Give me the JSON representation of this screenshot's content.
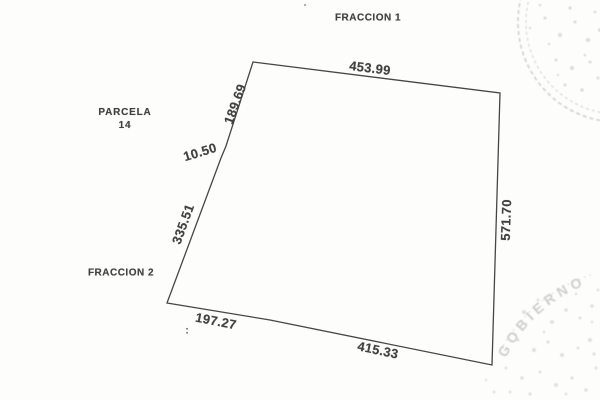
{
  "labels": {
    "fraccion1": "FRACCION 1",
    "parcela_line1": "PARCELA",
    "parcela_line2": "14",
    "fraccion2": "FRACCION 2",
    "stray_mark": ":"
  },
  "measurements": {
    "top": "453.99",
    "upper_left": "189.69",
    "notch": "10.50",
    "left": "335.51",
    "bottom_left": "197.27",
    "bottom": "415.33",
    "right": "571.70"
  },
  "stamps": {
    "bottom_right_arc_text": "GOBIERNO"
  },
  "colors": {
    "outline": "#464646",
    "label_text": "#414141",
    "stamp": "#c4c4c4",
    "paper": "#fdfdfc"
  }
}
